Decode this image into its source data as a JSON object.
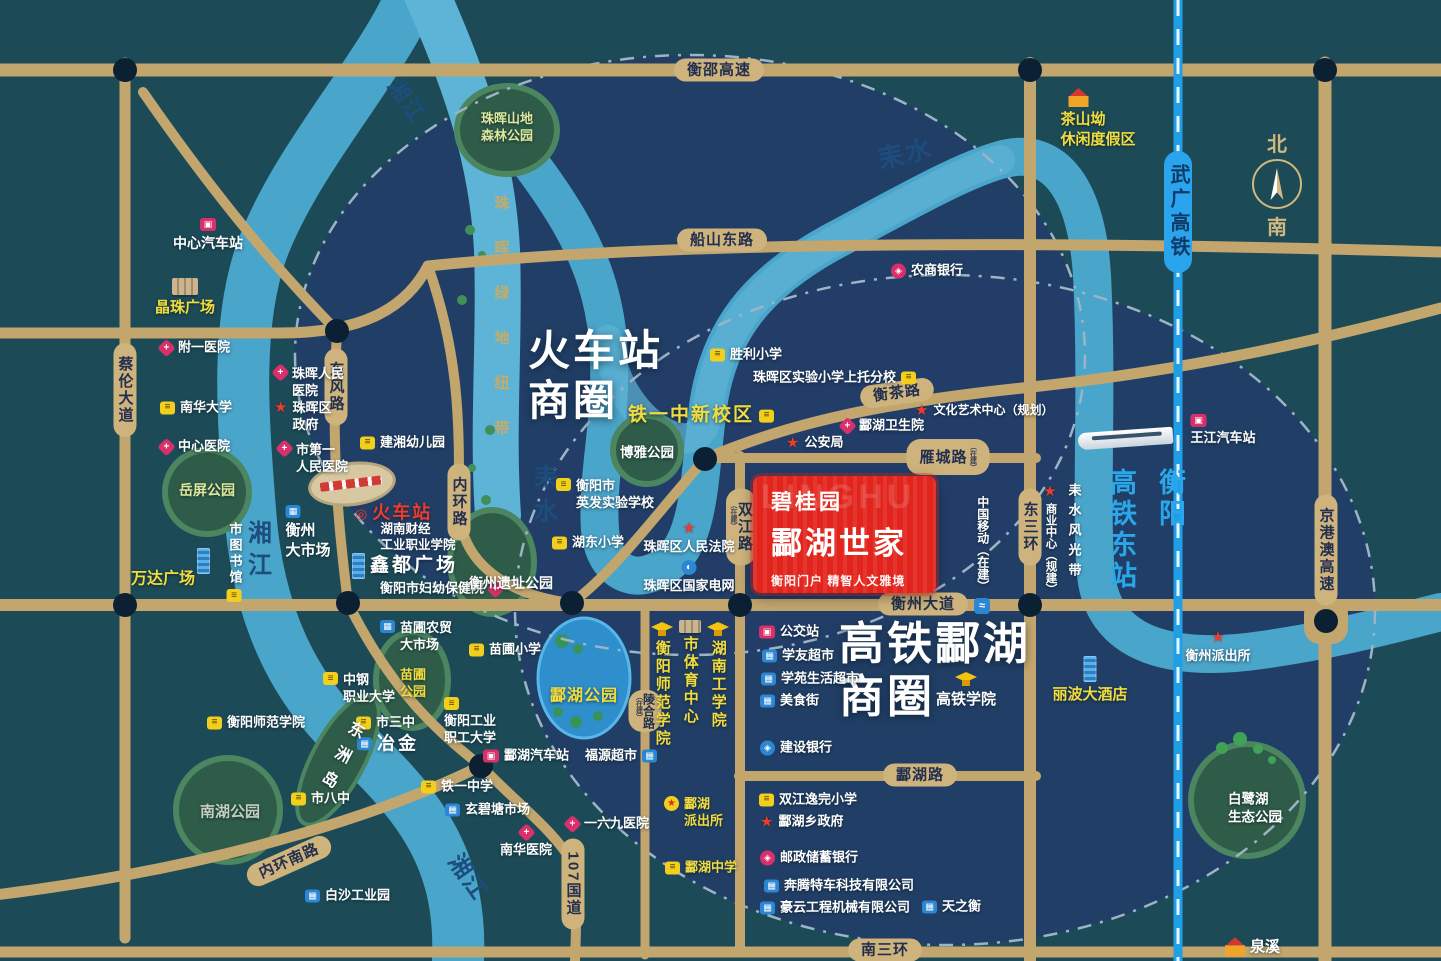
{
  "compass": {
    "north": "北",
    "south": "南"
  },
  "project": {
    "brand": "碧桂园",
    "name": "酃湖世家",
    "tagline": "衡阳门户 精智人文雅境",
    "watermark": "LINGHU"
  },
  "zones": [
    {
      "line1": "火车站",
      "line2": "商圈"
    },
    {
      "line1": "高铁酃湖",
      "line2": "商圈"
    }
  ],
  "stations": {
    "hsr_east": {
      "line1": "衡阳",
      "line2": "高铁东站"
    }
  },
  "roads": [
    {
      "label": "衡邵高速"
    },
    {
      "label": "船山东路"
    },
    {
      "label": "衡茶路"
    },
    {
      "label": "雁城路",
      "suffix": "（在建）"
    },
    {
      "label": "衡州大道"
    },
    {
      "label": "酃湖路"
    },
    {
      "label": "南三环"
    },
    {
      "label": "内环南路"
    },
    {
      "label": "蔡伦大道"
    },
    {
      "label": "东风路"
    },
    {
      "label": "内环路"
    },
    {
      "label": "双江路",
      "suffix": "（在建）"
    },
    {
      "label": "东三环"
    },
    {
      "label": "陵合路",
      "suffix": "（在建）"
    },
    {
      "label": "107国道"
    },
    {
      "label": "武广高铁"
    },
    {
      "label": "京港澳高速"
    }
  ],
  "rivers": [
    {
      "label": "湘江"
    },
    {
      "label": "湘江"
    },
    {
      "label": "湘江"
    },
    {
      "label": "耒水"
    },
    {
      "label": "耒水"
    },
    {
      "label": "珠晖绿地纽带"
    }
  ],
  "glyphs": {
    "school": "≡",
    "hospital": "+",
    "market": "▦",
    "bus": "▣",
    "bank": "◈",
    "bank_blue": "◈",
    "grid": "◐",
    "star": "★",
    "police_star": "★",
    "mobile": "≈",
    "rail_ring": "◎"
  },
  "pois": [
    {
      "label": "中心汽车站",
      "icon": "bus"
    },
    {
      "label": "晶珠广场",
      "icon": "building"
    },
    {
      "label": "附一医院",
      "icon": "hospital"
    },
    {
      "label": "南华大学",
      "icon": "school"
    },
    {
      "label": "中心医院",
      "icon": "hospital"
    },
    {
      "label": "岳屏公园",
      "icon": "park"
    },
    {
      "label": "万达广场",
      "icon": "tower"
    },
    {
      "label": "市图书馆",
      "icon": "library"
    },
    {
      "label": "珠晖人民\n医院",
      "icon": "hospital"
    },
    {
      "label": "珠晖区\n政府",
      "icon": "gov-star"
    },
    {
      "label": "市第一\n人民医院",
      "icon": "hospital"
    },
    {
      "label": "衡州\n大市场",
      "icon": "market"
    },
    {
      "label": "建湘幼儿园",
      "icon": "school"
    },
    {
      "label": "火车站",
      "icon": "rail-ring"
    },
    {
      "label": "湖南财经\n工业职业学院"
    },
    {
      "label": "鑫都广场",
      "icon": "tower"
    },
    {
      "label": "衡阳市妇幼保健院",
      "icon": "hospital"
    },
    {
      "label": "苗圃农贸\n大市场",
      "icon": "market"
    },
    {
      "label": "苗圃小学",
      "icon": "school"
    },
    {
      "label": "中钢\n职业大学",
      "icon": "school"
    },
    {
      "label": "苗圃\n公园",
      "icon": "park"
    },
    {
      "label": "市三中",
      "icon": "school"
    },
    {
      "label": "冶金",
      "icon": "market"
    },
    {
      "label": "东洲岛",
      "icon": "island"
    },
    {
      "label": "衡阳师范学院",
      "icon": "school"
    },
    {
      "label": "市八中",
      "icon": "school"
    },
    {
      "label": "南湖公园",
      "icon": "park"
    },
    {
      "label": "白沙工业园",
      "icon": "market"
    },
    {
      "label": "衡阳工业\n职工大学",
      "icon": "school"
    },
    {
      "label": "铁一中学",
      "icon": "school"
    },
    {
      "label": "玄碧塘市场",
      "icon": "market"
    },
    {
      "label": "南华医院",
      "icon": "hospital"
    },
    {
      "label": "一六九医院",
      "icon": "hospital"
    },
    {
      "label": "酃湖汽车站",
      "icon": "bus"
    },
    {
      "label": "福源超市",
      "icon": "market"
    },
    {
      "label": "酃湖公园",
      "icon": "park"
    },
    {
      "label": "衡阳师范学院",
      "icon": "grad-cap"
    },
    {
      "label": "市体育中心",
      "icon": "stadium"
    },
    {
      "label": "湖南工学院",
      "icon": "grad-cap"
    },
    {
      "label": "酃湖\n派出所",
      "icon": "police-star"
    },
    {
      "label": "酃湖中学",
      "icon": "school"
    },
    {
      "label": "双江逸完小学",
      "icon": "school"
    },
    {
      "label": "酃湖乡政府",
      "icon": "gov-star"
    },
    {
      "label": "邮政储蓄银行",
      "icon": "bank"
    },
    {
      "label": "奔腾特车科技有限公司",
      "icon": "company"
    },
    {
      "label": "豪云工程机械有限公司",
      "icon": "company"
    },
    {
      "label": "天之衡",
      "icon": "company"
    },
    {
      "label": "公交站",
      "icon": "bus"
    },
    {
      "label": "学友超市",
      "icon": "market"
    },
    {
      "label": "学苑生活超市",
      "icon": "market"
    },
    {
      "label": "美食街",
      "icon": "market"
    },
    {
      "label": "建设银行",
      "icon": "bank-blue"
    },
    {
      "label": "高铁学院",
      "icon": "grad-cap"
    },
    {
      "label": "丽波大酒店",
      "icon": "tower"
    },
    {
      "label": "胜利小学",
      "icon": "school"
    },
    {
      "label": "珠晖区实验小学上托分校",
      "icon": "school"
    },
    {
      "label": "铁一中新校区",
      "icon": "school"
    },
    {
      "label": "博雅公园",
      "icon": "park"
    },
    {
      "label": "衡阳市\n英发实验学校",
      "icon": "school"
    },
    {
      "label": "湖东小学",
      "icon": "school"
    },
    {
      "label": "衡州遗址公园",
      "icon": "park"
    },
    {
      "label": "珠晖区人民法院",
      "icon": "gov-star"
    },
    {
      "label": "珠晖区国家电网",
      "icon": "state-grid"
    },
    {
      "label": "农商银行",
      "icon": "bank"
    },
    {
      "label": "公安局",
      "icon": "gov-star"
    },
    {
      "label": "文化艺术中心（规划）",
      "icon": "gov-star"
    },
    {
      "label": "酃湖卫生院",
      "icon": "hospital"
    },
    {
      "label": "中国移动（在建）",
      "icon": "china-mobile"
    },
    {
      "label": "商业中心（规建）",
      "icon": "gov-star"
    },
    {
      "label": "耒水风光带"
    },
    {
      "label": "王江汽车站",
      "icon": "bus"
    },
    {
      "label": "衡州派出所",
      "icon": "gov-star"
    },
    {
      "label": "白鹭湖\n生态公园",
      "icon": "park"
    },
    {
      "label": "泉溪",
      "icon": "house"
    },
    {
      "label": "茶山坳\n休闲度假区",
      "icon": "house"
    },
    {
      "label": "珠晖山地\n森林公园",
      "icon": "park"
    }
  ]
}
